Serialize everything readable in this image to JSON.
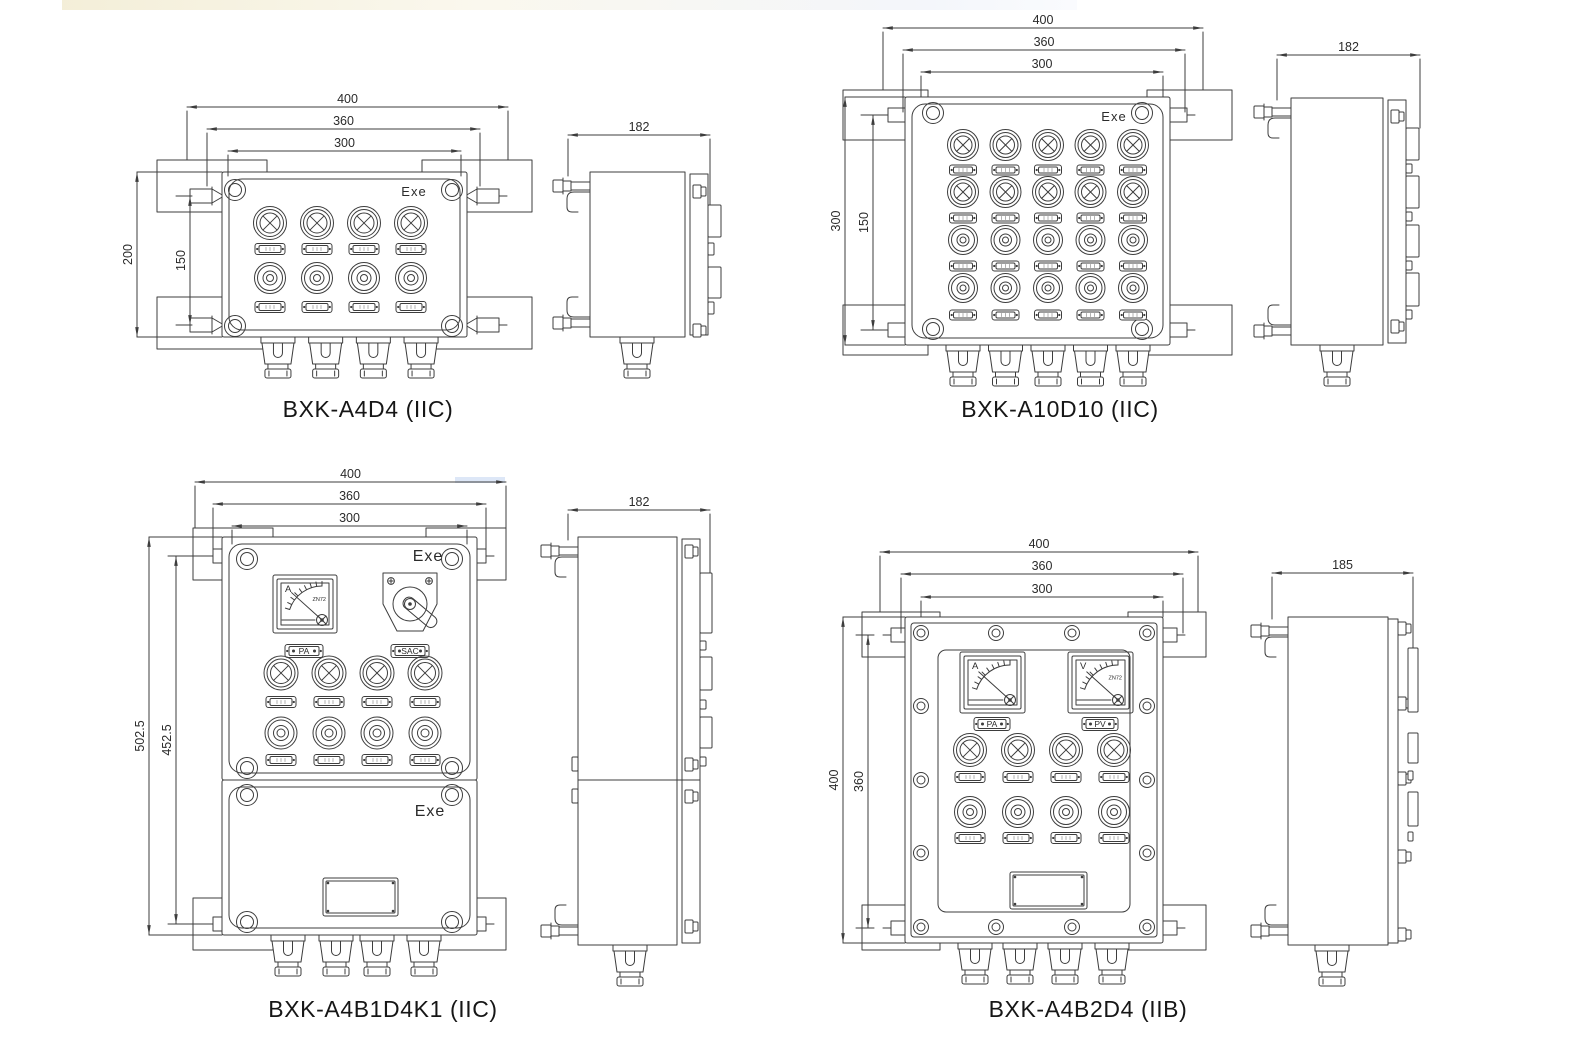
{
  "page": {
    "background": "#ffffff",
    "line_color": "#3d3d3d",
    "text_color": "#2b2b2b",
    "title_color": "#161616"
  },
  "drawings": [
    {
      "title": "BXK-A4D4 (IIC)",
      "exe_labels": [
        "Exe"
      ],
      "front": {
        "width_dims": [
          "400",
          "360",
          "300"
        ],
        "height_dims": [
          "200",
          "150"
        ],
        "lamp_count": 4,
        "button_count": 4,
        "gland_count": 4
      },
      "side": {
        "width_dim": "182"
      }
    },
    {
      "title": "BXK-A10D10 (IIC)",
      "exe_labels": [
        "Exe"
      ],
      "front": {
        "width_dims": [
          "400",
          "360",
          "300"
        ],
        "height_dims": [
          "300",
          "150"
        ],
        "lamp_count": 10,
        "button_count": 10,
        "gland_count": 5
      },
      "side": {
        "width_dim": "182"
      }
    },
    {
      "title": "BXK-A4B1D4K1 (IIC)",
      "exe_labels": [
        "Exe",
        "Exe"
      ],
      "front": {
        "width_dims": [
          "400",
          "360",
          "300"
        ],
        "height_dims": [
          "502.5",
          "452.5"
        ],
        "meters": [
          {
            "dial": "A",
            "model": "ZN72",
            "plate": "PA"
          }
        ],
        "switches": [
          {
            "plate": "SAC"
          }
        ],
        "lamp_count": 4,
        "button_count": 4,
        "gland_count": 4,
        "has_nameplate": true
      },
      "side": {
        "width_dim": "182"
      }
    },
    {
      "title": "BXK-A4B2D4 (IIB)",
      "exe_labels": [],
      "front": {
        "width_dims": [
          "400",
          "360",
          "300"
        ],
        "height_dims": [
          "400",
          "360"
        ],
        "meters": [
          {
            "dial": "A",
            "model": "",
            "plate": "PA"
          },
          {
            "dial": "V",
            "model": "ZN72",
            "plate": "PV"
          }
        ],
        "lamp_count": 4,
        "button_count": 4,
        "gland_count": 4,
        "has_nameplate": true
      },
      "side": {
        "width_dim": "185"
      }
    }
  ]
}
